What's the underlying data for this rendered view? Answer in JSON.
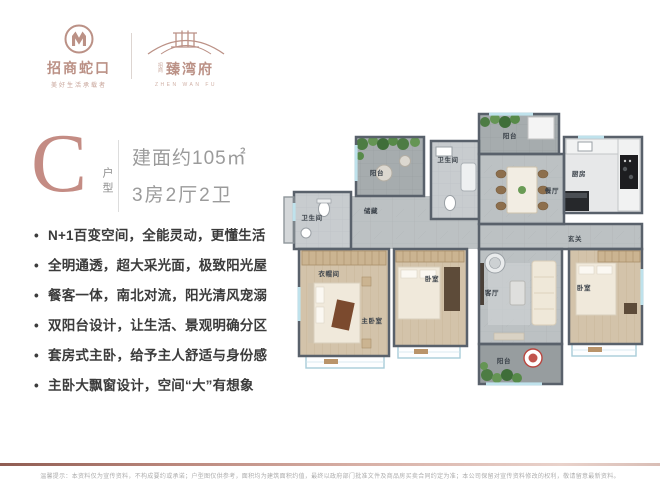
{
  "header": {
    "brand1": {
      "name": "招商蛇口",
      "tagline": "美好生活承载者"
    },
    "brand2": {
      "prefix_top": "招",
      "prefix_bottom": "商",
      "name": "臻湾府",
      "subtext": "ZHEN WAN FU"
    }
  },
  "unit": {
    "letter": "C",
    "suffix": "户型",
    "area": "建面约105㎡",
    "layout": "3房2厅2卫"
  },
  "features": [
    "N+1百变空间，全能灵动，更懂生活",
    "全明通透，超大采光面，极致阳光屋",
    "餐客一体，南北对流，阳光清风宠溺",
    "双阳台设计，让生活、景观明确分区",
    "套房式主卧，给予主人舒适与身份感",
    "主卧大飘窗设计，空间“大”有想象"
  ],
  "floorplan": {
    "rooms": [
      {
        "id": "balcony-top-left",
        "label": "阳台"
      },
      {
        "id": "bath-left",
        "label": "卫生间"
      },
      {
        "id": "storage",
        "label": "储藏"
      },
      {
        "id": "bath-middle",
        "label": "卫生间"
      },
      {
        "id": "balcony-top-right",
        "label": "阳台"
      },
      {
        "id": "kitchen",
        "label": "厨房"
      },
      {
        "id": "dining",
        "label": "餐厅"
      },
      {
        "id": "foyer",
        "label": "玄关"
      },
      {
        "id": "closet",
        "label": "衣帽间"
      },
      {
        "id": "master-bedroom",
        "label": "主卧室"
      },
      {
        "id": "bedroom-middle",
        "label": "卧室"
      },
      {
        "id": "living",
        "label": "客厅"
      },
      {
        "id": "bedroom-right",
        "label": "卧室"
      },
      {
        "id": "balcony-bottom",
        "label": "阳台"
      }
    ]
  },
  "footer": {
    "disclaimer": "温馨提示：本资料仅为宣传资料，不构成要约或承诺；户型图仅供参考，面积均为建筑面积约值，最终以政府部门批准文件及商品房买卖合同约定为准；本公司保留对宣传资料修改的权利，敬请留意最新资料。"
  },
  "colors": {
    "accent_rose": "#bb9186",
    "letter_rose": "#c48c84",
    "spec_gray": "#9b9b9b",
    "feature_text": "#3b3b3b",
    "wall": "#59616b",
    "wood_floor": "#d3c3aa",
    "marble_floor": "#bcc1c3",
    "balcony_floor": "#a6acae",
    "window_blue": "#bfe2ec",
    "plant_green": "#4d7c44",
    "footer_gradient_dark": "#8f5c52",
    "footer_gradient_light": "#e9d2cb"
  }
}
